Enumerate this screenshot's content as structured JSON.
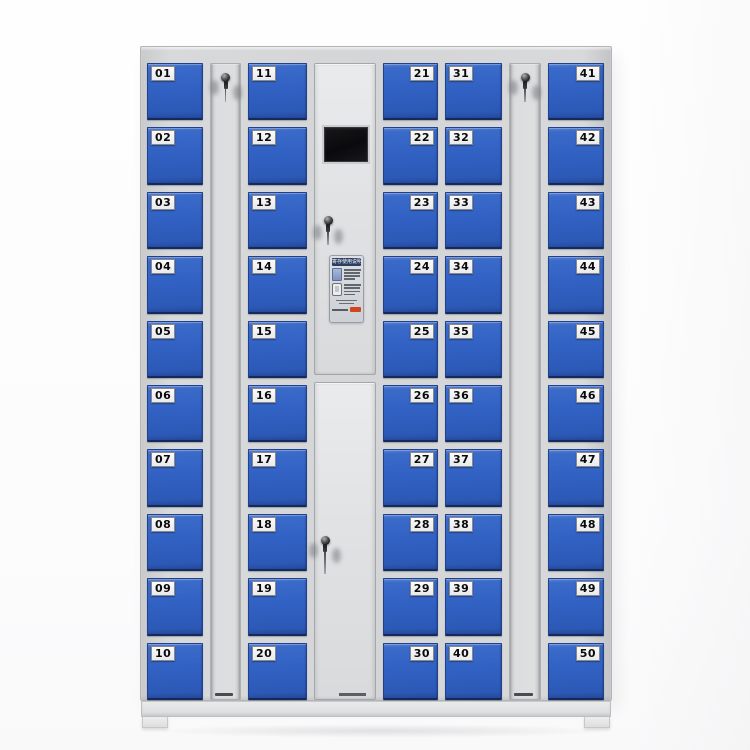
{
  "image": {
    "subject": "50-door electronic storage locker cabinet, gray frame with blue numbered doors"
  },
  "locker": {
    "door_columns": [
      {
        "name": "column-1",
        "label_side": "left",
        "numbers": [
          "01",
          "02",
          "03",
          "04",
          "05",
          "06",
          "07",
          "08",
          "09",
          "10"
        ]
      },
      {
        "name": "column-2",
        "label_side": "left",
        "numbers": [
          "11",
          "12",
          "13",
          "14",
          "15",
          "16",
          "17",
          "18",
          "19",
          "20"
        ]
      },
      {
        "name": "column-3",
        "label_side": "right",
        "numbers": [
          "21",
          "22",
          "23",
          "24",
          "25",
          "26",
          "27",
          "28",
          "29",
          "30"
        ]
      },
      {
        "name": "column-4",
        "label_side": "left",
        "numbers": [
          "31",
          "32",
          "33",
          "34",
          "35",
          "36",
          "37",
          "38",
          "39",
          "40"
        ]
      },
      {
        "name": "column-5",
        "label_side": "right",
        "numbers": [
          "41",
          "42",
          "43",
          "44",
          "45",
          "46",
          "47",
          "48",
          "49",
          "50"
        ]
      }
    ],
    "key_panels": [
      {
        "name": "key-panel-left",
        "lock": "keyed cam lock with key and tag inserted"
      },
      {
        "name": "key-panel-right",
        "lock": "keyed cam lock with key and tag inserted"
      }
    ],
    "control_panel": {
      "screen": {
        "name": "lcd-display",
        "state": "off"
      },
      "sticker": {
        "title": "寄存使用说明",
        "badge_color": "#d2451f"
      },
      "locks": [
        "upper-key-lock",
        "lower-key-lock"
      ]
    },
    "colors": {
      "door_blue": "#3161c3",
      "frame_gray": "#d4d5d7",
      "panel_gray": "#e0e1e3",
      "label_bg": "#f1f2f4",
      "label_text": "#0a0a0b",
      "screen_black": "#0e0e10",
      "background": "#fdfdfd"
    }
  }
}
